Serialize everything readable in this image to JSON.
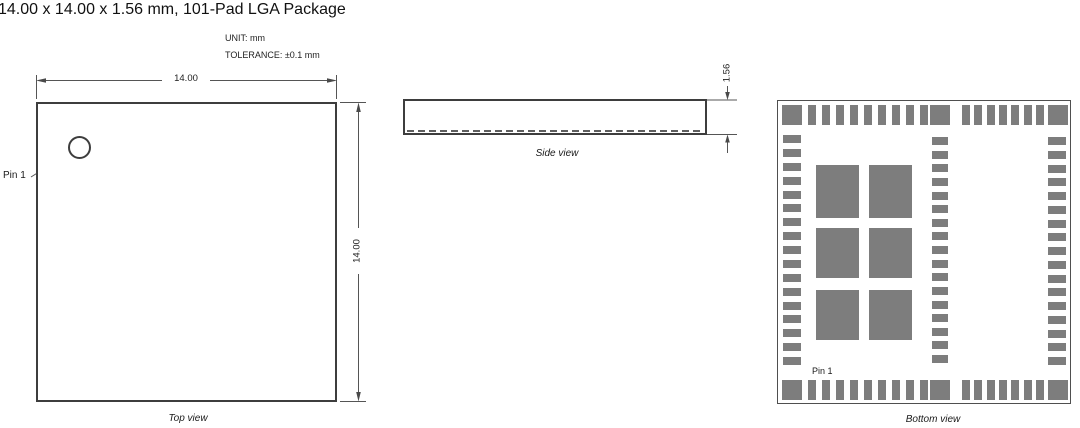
{
  "title": "14.00 x 14.00 x 1.56 mm, 101-Pad LGA Package",
  "notes": {
    "unit": "UNIT: mm",
    "tolerance": "TOLERANCE: ±0.1 mm"
  },
  "colors": {
    "pad_gray": "#7d7d7d",
    "line": "#555555",
    "outline": "#3d3d3d"
  },
  "top_view": {
    "label": "Top view",
    "pin1_label": "Pin 1",
    "width_dim": "14.00",
    "height_dim": "14.00"
  },
  "side_view": {
    "label": "Side view",
    "thickness_dim": "1.56"
  },
  "bottom_view": {
    "label": "Bottom view",
    "pin1_label": "Pin 1",
    "pads": {
      "corner_pads": 4,
      "mid_edge_square_pads": 2,
      "top_edge": {
        "left_group": 9,
        "right_group": 7
      },
      "bottom_edge": {
        "left_group": 9,
        "right_group": 7
      },
      "left_edge": 17,
      "center_column": 17,
      "right_edge": 17,
      "center_grid": {
        "columns": 2,
        "rows": 3
      }
    }
  }
}
